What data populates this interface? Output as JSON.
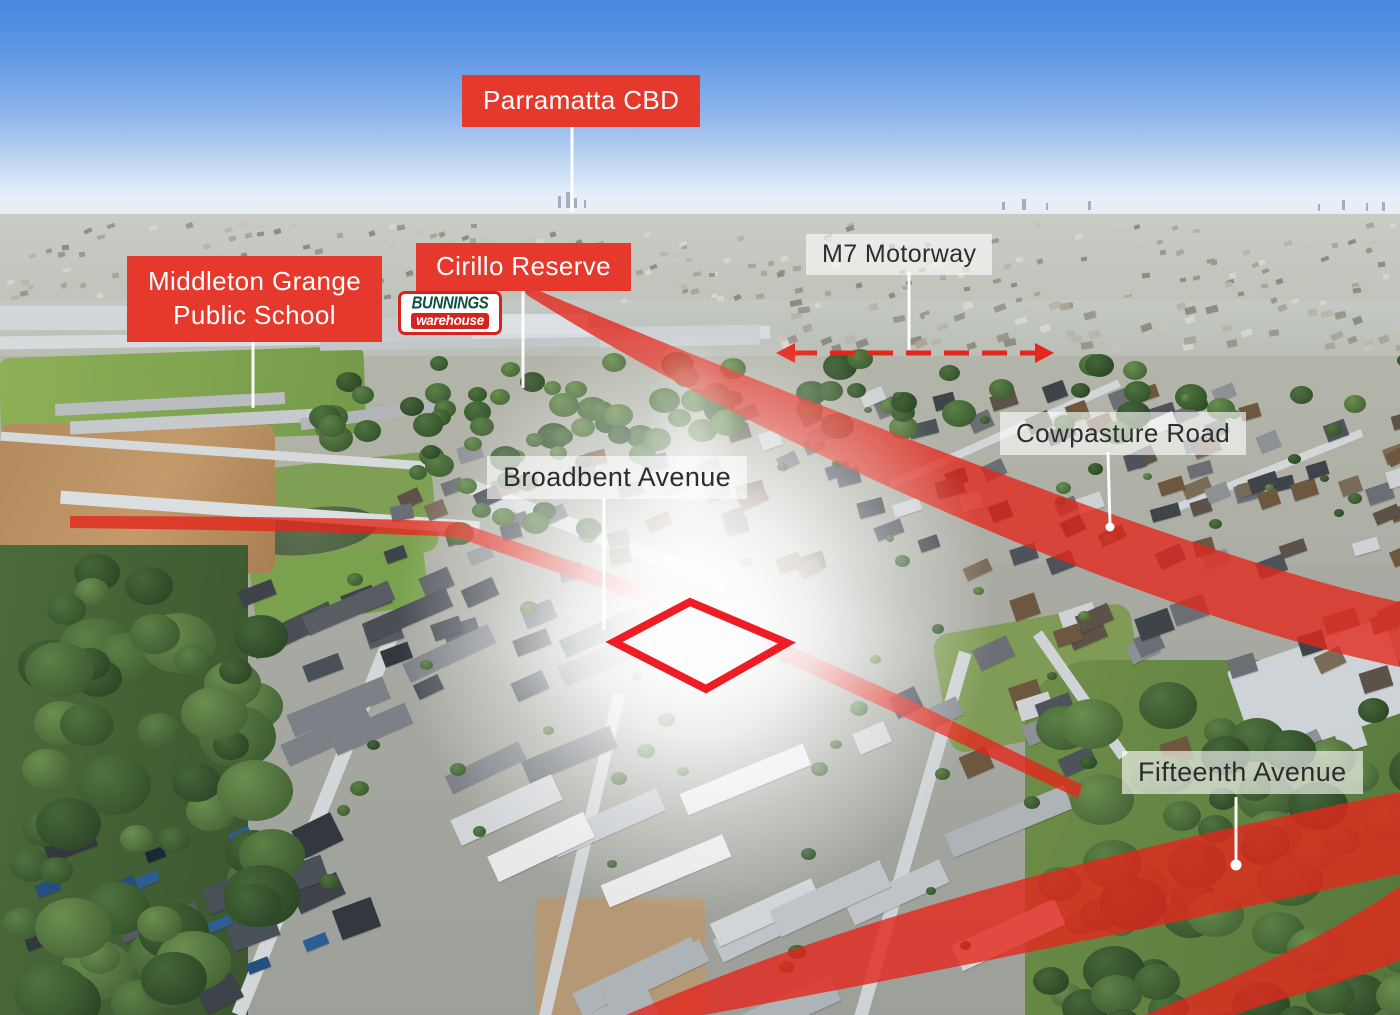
{
  "annotations": {
    "parramatta_cbd": "Parramatta CBD",
    "middleton_grange_line1": "Middleton Grange",
    "middleton_grange_line2": "Public School",
    "cirillo_reserve": "Cirillo Reserve",
    "m7_motorway": "M7 Motorway",
    "cowpasture_road": "Cowpasture Road",
    "broadbent_avenue": "Broadbent Avenue",
    "fifteenth_avenue": "Fifteenth Avenue"
  },
  "logo_bunnings": {
    "top": "BUNNINGS",
    "bottom": "warehouse"
  },
  "colors": {
    "badge_red": "#e5392d",
    "badge_text": "#ffffff",
    "overlay_red": "#e3271b",
    "outline_red": "#ee1c25",
    "label_bg": "rgba(255,255,255,0.62)",
    "label_text": "#2d2d2d",
    "leader_white": "#ffffff",
    "bunnings_green": "#0d4f42",
    "bunnings_red": "#d7231e"
  }
}
